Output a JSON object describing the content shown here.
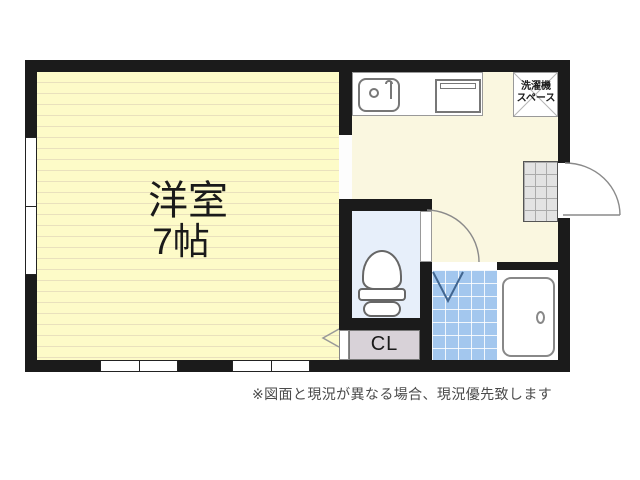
{
  "rooms": {
    "western_room": {
      "name_label": "洋室",
      "size_label": "7帖"
    },
    "closet": {
      "label": "CL"
    },
    "laundry_space": {
      "line1": "洗濯機",
      "line2": "スペース"
    }
  },
  "note": "※図面と現況が異なる場合、現況優先致します",
  "icons": [
    "sink-icon",
    "stove-icon",
    "toilet-icon",
    "bathtub-icon",
    "entrance-door-arc-icon",
    "toilet-door-arc-icon",
    "bath-door-mark-icon",
    "closet-door-mark-icon",
    "laundry-cross-icon"
  ],
  "colors": {
    "wall": "#1b1b1b",
    "room_floor": "#fdfbc8",
    "room_stripe": "#e9e1bd",
    "kitchen_floor": "#faf7e0",
    "toilet_floor": "#e7effa",
    "bath_tile": "#a3c7ee",
    "closet_fill": "#d8d2d8",
    "genkan_fill": "#e3e3e3",
    "text": "#1a1a1a",
    "note_text": "#4a4a4a",
    "line": "#8a8a8a"
  }
}
